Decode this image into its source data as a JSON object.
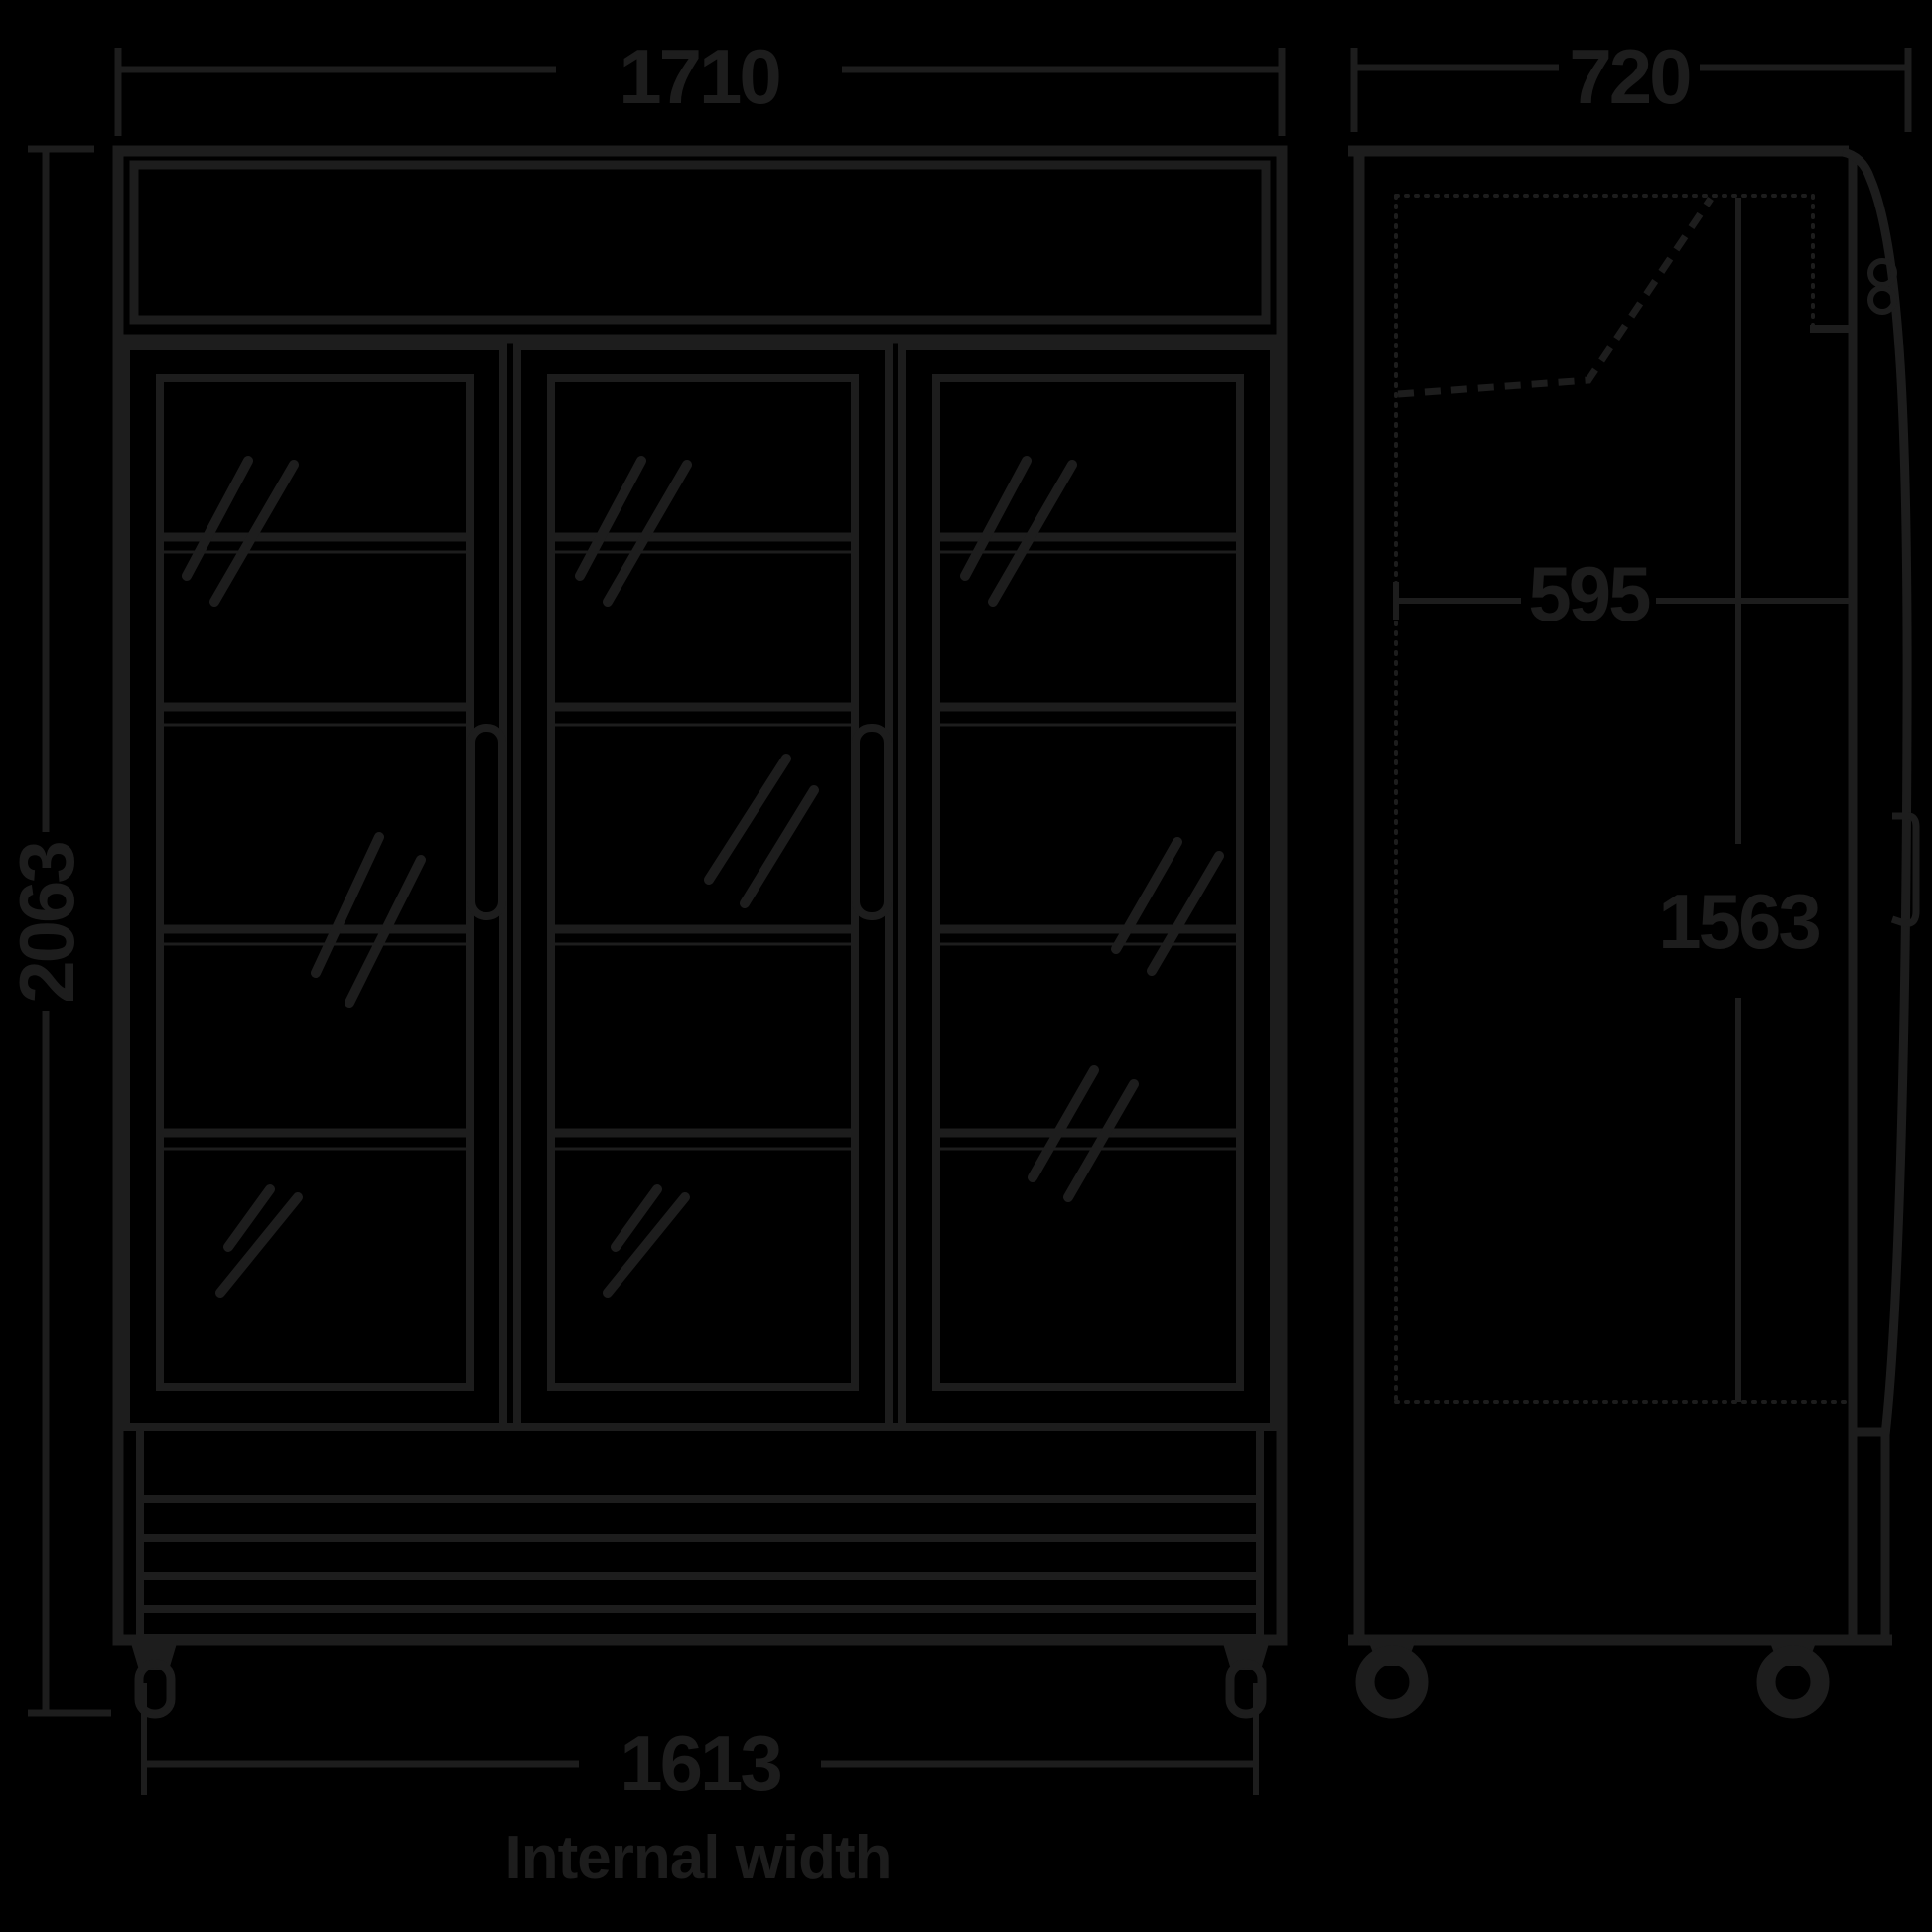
{
  "diagram": {
    "type": "technical-dimension-drawing",
    "subject": "three-glass-door upright display fridge, front and side elevations",
    "colors": {
      "background": "#000000",
      "line": "#1d1d1d"
    },
    "front_view": {
      "doors_depicted": 3,
      "shelf_lines_per_door": 4,
      "dimensions": {
        "width": {
          "value": "1710"
        },
        "height": {
          "value": "2063"
        },
        "internal_width": {
          "value": "1613",
          "caption": "Internal width"
        }
      }
    },
    "side_view": {
      "dimensions": {
        "depth": {
          "value": "720"
        },
        "internal_depth": {
          "value": "595"
        },
        "internal_height": {
          "value": "1563"
        }
      }
    }
  }
}
